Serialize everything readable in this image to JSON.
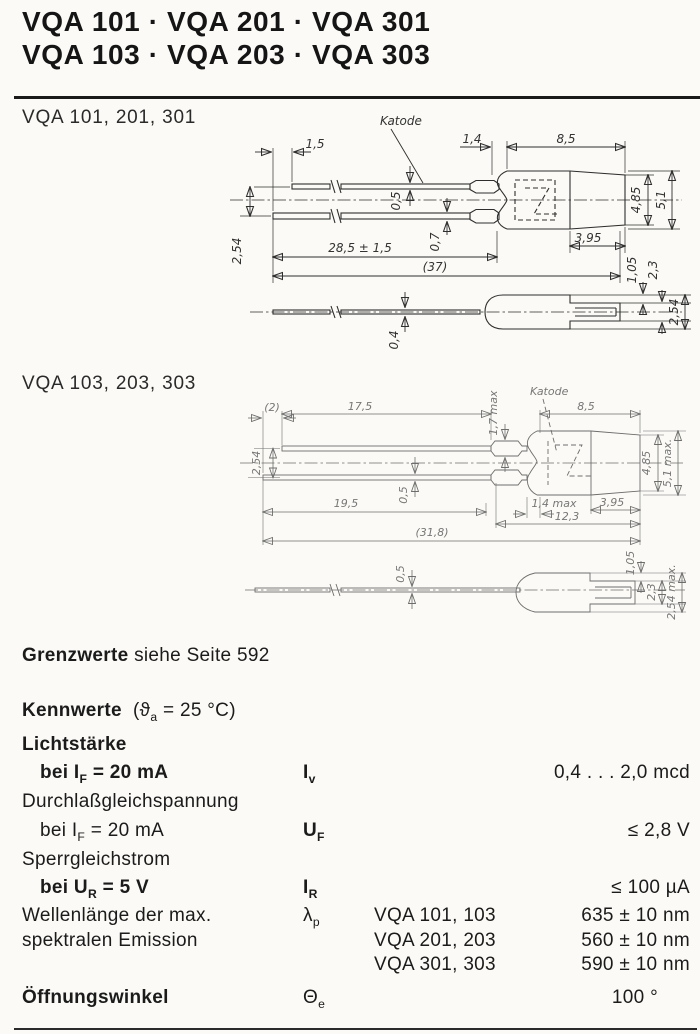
{
  "header": {
    "line1": "VQA 101 · VQA 201 · VQA 301",
    "line2": "VQA 103 · VQA 203 · VQA 303"
  },
  "sections": {
    "drawing1": {
      "title": "VQA 101, 201, 301",
      "cathode_label": "Katode",
      "dims": {
        "lead_stagger": "1,5",
        "dome": "1,4",
        "body_len": "8,5",
        "pitch": "2,54",
        "lead_thick_top": "0,5",
        "lead_thick_bottom": "0,7",
        "lead_len": "28,5 ± 1,5",
        "total_len": "(37)",
        "cap_len": "3,95",
        "cap_dia": "4,85",
        "body_dia": "5,1",
        "step": "1,05",
        "tongue": "2,3",
        "tongue_max": "2,54",
        "side_lead_thick": "0,4"
      }
    },
    "drawing2": {
      "title": "VQA 103, 203, 303",
      "cathode_label": "Katode",
      "dims": {
        "lead_stagger": "(2)",
        "lead_top_len": "17,5",
        "crimp": "1,7 max",
        "body_len": "8,5",
        "pitch": "2,54",
        "lead_thick": "0,5",
        "lead_bottom_len": "19,5",
        "dome": "1,4 max",
        "inner_len": "12,3",
        "cap_len": "3,95",
        "total_len": "(31,8)",
        "cap_dia": "4,85",
        "body_dia": "5,1 max.",
        "side_lead_thick": "0,5",
        "step": "1,05",
        "tongue": "2,3",
        "tongue_max": "2,54 max."
      }
    }
  },
  "grenzwerte": {
    "label": "Grenzwerte",
    "note": "siehe Seite 592"
  },
  "kennwerte": {
    "heading": "Kennwerte",
    "cond_pre": "(ϑ",
    "cond_sub": "a",
    "cond_post": " = 25 °C)",
    "rows": [
      {
        "group": "Lichtstärke"
      },
      {
        "cond_pre": "bei I",
        "cond_sub": "F",
        "cond_post": " = 20 mA",
        "sym": "I",
        "sym_sub": "v",
        "value": "0,4 . . . 2,0 mcd"
      },
      {
        "group": "Durchlaßgleichspannung"
      },
      {
        "cond_pre": "bei I",
        "cond_sub": "F",
        "cond_post": " = 20 mA",
        "sym": "U",
        "sym_sub": "F",
        "value": "≤ 2,8 V"
      },
      {
        "group": "Sperrgleichstrom"
      },
      {
        "cond_pre": "bei U",
        "cond_sub": "R",
        "cond_post": " = 5 V",
        "sym": "I",
        "sym_sub": "R",
        "value": "≤ 100 µA"
      }
    ],
    "wavelength": {
      "label1": "Wellenlänge der max.",
      "label2": "spektralen Emission",
      "sym": "λ",
      "sym_sub": "p",
      "variants": [
        {
          "types": "VQA 101, 103",
          "value": "635 ± 10 nm"
        },
        {
          "types": "VQA 201, 203",
          "value": "560 ± 10 nm"
        },
        {
          "types": "VQA 301, 303",
          "value": "590 ± 10 nm"
        }
      ]
    },
    "angle": {
      "label": "Öffnungswinkel",
      "sym": "Θ",
      "sym_sub": "e",
      "value": "100 °"
    }
  }
}
